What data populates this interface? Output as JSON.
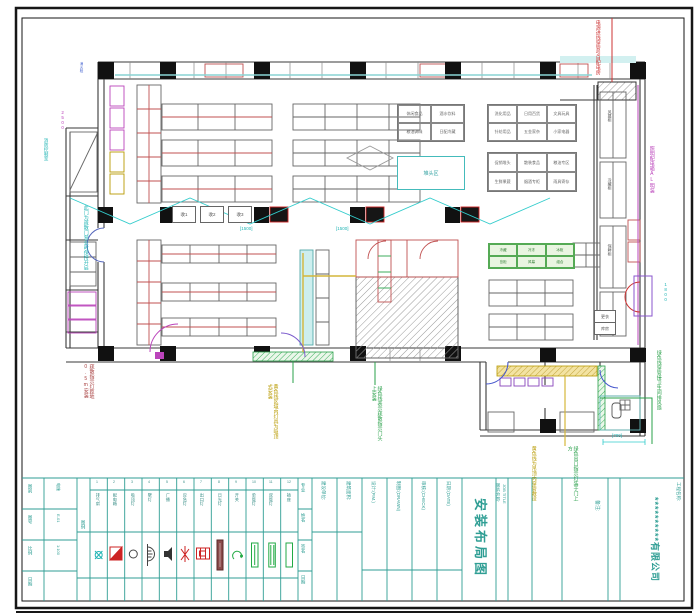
{
  "colors": {
    "teal": "#2f9e94",
    "red": "#cc2222",
    "green": "#2aa04a",
    "cyan": "#22b5b5",
    "magenta": "#bb44bb",
    "olive": "#b89a00"
  },
  "plan": {
    "zone_table_a": [
      "休闲食品",
      "酒水饮料",
      "粮油调味",
      "日配冷藏"
    ],
    "zone_table_b": [
      "洗化用品",
      "日用百货",
      "文具玩具",
      "针纺用品",
      "五金家杂",
      "小家电器"
    ],
    "zone_table_c": [
      "促销堆头",
      "散装食品",
      "粮油专区",
      "生鲜果蔬",
      "烟酒专柜",
      "雨具寄存"
    ],
    "green_cells": [
      "冷藏",
      "冷冻",
      "冰柜",
      "岛柜",
      "风幕",
      "组合"
    ],
    "stack_area_label": "堆头区",
    "checkout_labels": [
      "收1",
      "收2",
      "收3"
    ],
    "corridor_labels": [
      "风幕柜",
      "冷藏柜",
      "保鲜柜"
    ],
    "small_rooms": [
      "更衣",
      "库房"
    ],
    "dims": {
      "checkout": "[1500]",
      "annex": "[700]",
      "door": "1800",
      "ramp": "2500"
    }
  },
  "annotations": {
    "power_in": "电源进线穿管引自配电房",
    "dist_box": "照明配电箱AL明装",
    "green_right": "绿色线穿管接卫生间排风扇",
    "fire_room": "消防控制室",
    "hydrant": "消火栓",
    "door_note": "此门为疏散门营业时保持开启",
    "exit_note": "疏散指示灯距地0.5m安装",
    "yellow_a": "黄色线区域内灯具为吸顶式安装",
    "green_a": "绿色线表示疏散指示门头上安装",
    "yellow_b": "黄色线为吊顶内穿管敷设",
    "green_b": "绿色出口指示灯装于门上方"
  },
  "title_block": {
    "company_label": "工程名称:",
    "company_name": "**********有限公司",
    "job_title_label": "图纸名称:",
    "job_title_en": "JOB TITLE",
    "drawing_title": "安装布局图",
    "remark_label": "备注:",
    "sign_rows": [
      "专业",
      "姓名",
      "签名",
      "日期"
    ],
    "fields": [
      {
        "label": "建设单位:"
      },
      {
        "label": "建筑面积:"
      },
      {
        "label": "设计:(P.M.)"
      },
      {
        "label": "制图:(DRAWN)"
      },
      {
        "label": "审核:(CHECK)"
      },
      {
        "label": "日期:(DATE)"
      }
    ],
    "info_table": [
      {
        "label": "图别",
        "value": "电施"
      },
      {
        "label": "图号",
        "value": "E-01"
      },
      {
        "label": "比例",
        "value": "1:100"
      },
      {
        "label": "日期",
        "value": ""
      }
    ],
    "legend_title": "图例",
    "legend_items": [
      {
        "no": "1",
        "name": "排气扇"
      },
      {
        "no": "2",
        "name": "配电箱"
      },
      {
        "no": "3",
        "name": "吸顶灯"
      },
      {
        "no": "4",
        "name": "壁灯"
      },
      {
        "no": "5",
        "name": "广播"
      },
      {
        "no": "6",
        "name": "应急灯"
      },
      {
        "no": "7",
        "name": "出口灯"
      },
      {
        "no": "8",
        "name": "日光灯"
      },
      {
        "no": "9",
        "name": "开关"
      },
      {
        "no": "10",
        "name": "单管灯"
      },
      {
        "no": "11",
        "name": "双管灯"
      },
      {
        "no": "12",
        "name": "插座"
      }
    ]
  }
}
